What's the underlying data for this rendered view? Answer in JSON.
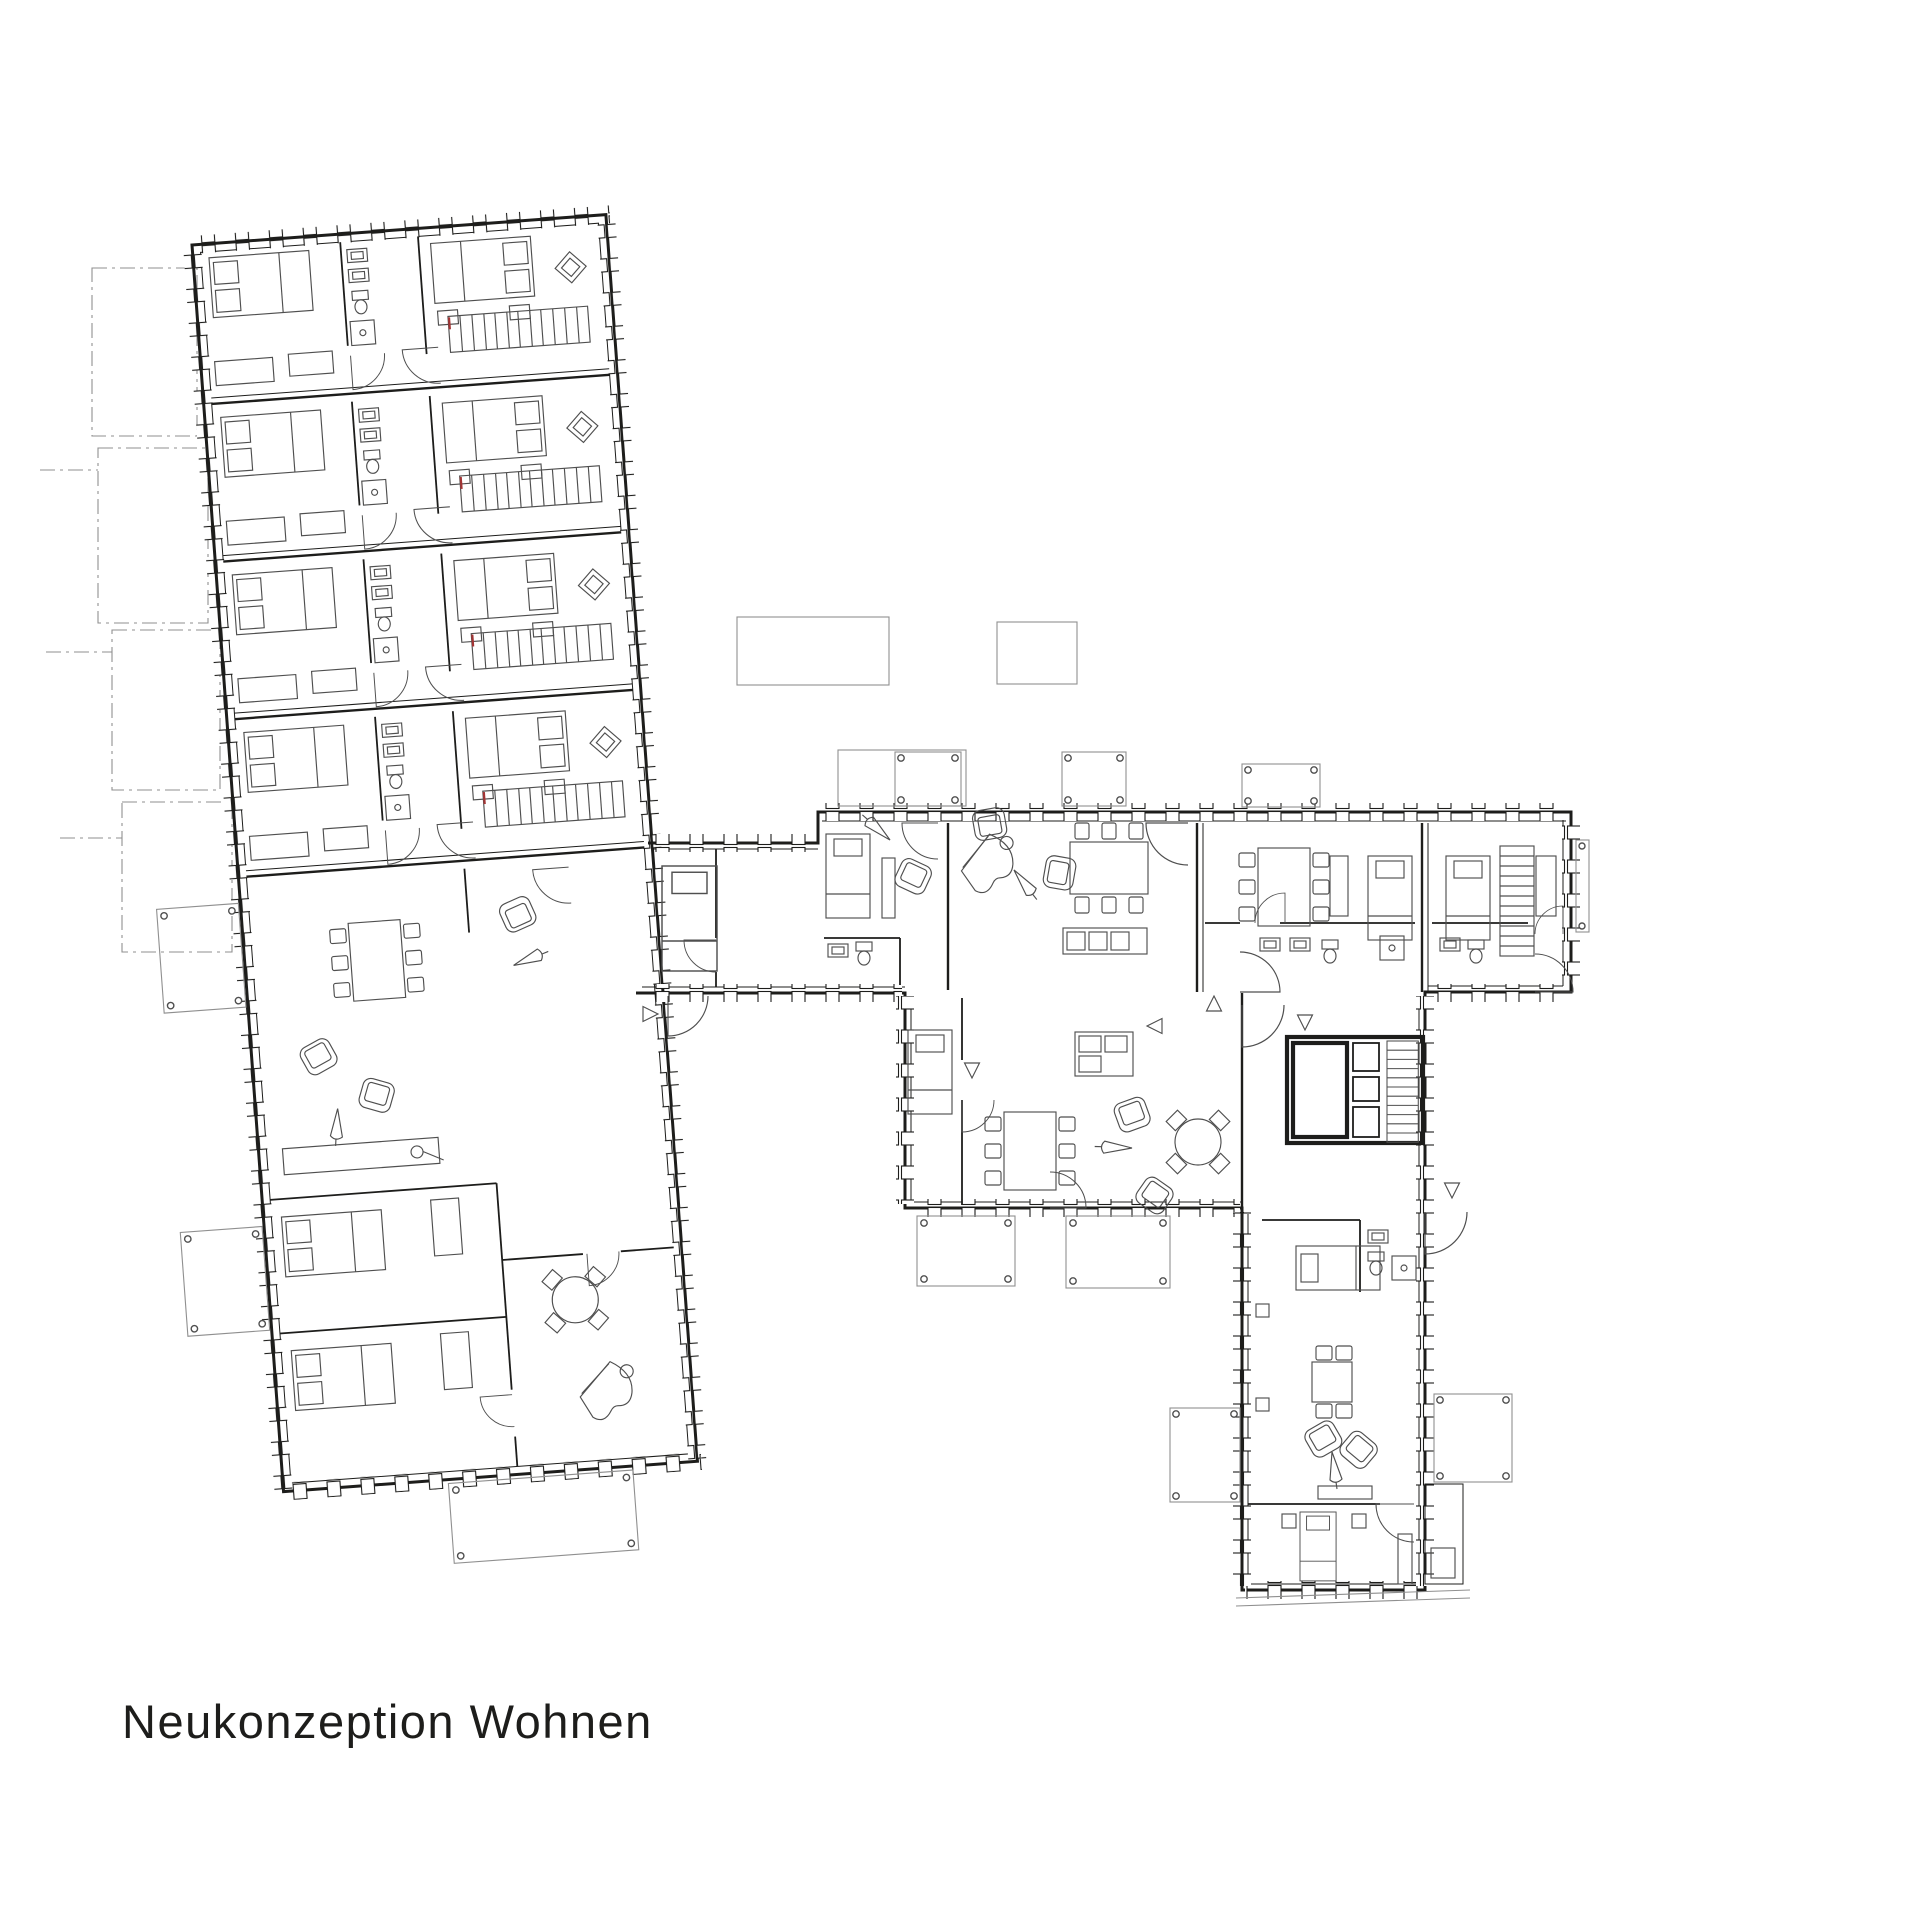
{
  "title": {
    "text": "Neukonzeption Wohnen"
  },
  "theme": {
    "bg": "#ffffff",
    "ink": "#1d1d1b",
    "fur": "#4f4f4f",
    "lt": "#8f8f8f",
    "red": "#a33434"
  },
  "plan": {
    "wings": [
      "north-wing",
      "link-wing",
      "main-wing",
      "south-wing"
    ],
    "symbols": [
      "bed",
      "single-bed",
      "wardrobe",
      "desk",
      "dining-table",
      "chair",
      "round-table",
      "armchair",
      "floor-lamp",
      "grand-piano",
      "tv-sideboard",
      "kitchen-counter",
      "staircase",
      "elevator-core",
      "door-swing",
      "balcony",
      "upper-floor-balcony",
      "bathroom-sink",
      "toilet",
      "shower",
      "diamond-ornament",
      "direction-triangle"
    ]
  }
}
